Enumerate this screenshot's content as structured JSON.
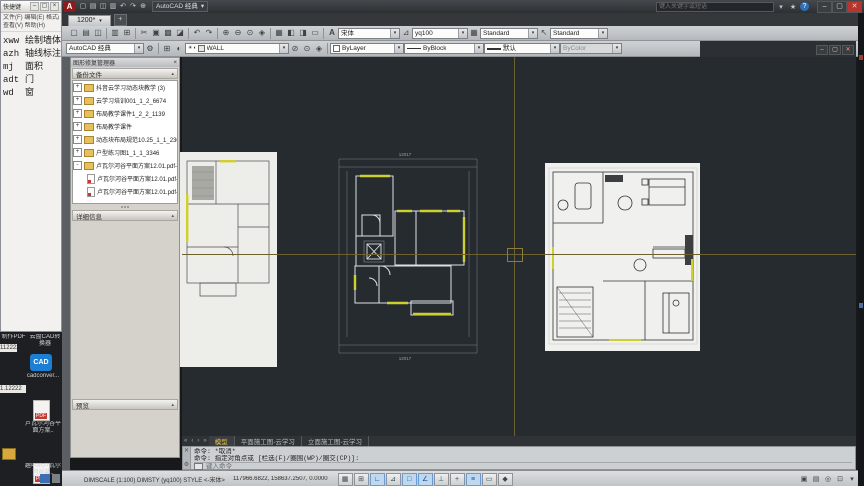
{
  "notepad": {
    "title": "快捷键",
    "menu1": "文件(F) 编辑(E) 格式(O)",
    "menu2": "查看(V) 帮助(H)",
    "entries": [
      {
        "k": "xww",
        "v": "绘制墙体"
      },
      {
        "k": "azh",
        "v": "轴线标注"
      },
      {
        "k": "mj",
        "v": "面积"
      },
      {
        "k": "adt",
        "v": "门"
      },
      {
        "k": "wd",
        "v": "窗"
      }
    ],
    "controls": {
      "min": "–",
      "max": "▢",
      "close": "×"
    }
  },
  "desktop": {
    "caption_left": "制作PDF",
    "caption_right": "云盘CAD转换器",
    "cad_icon_text": "CAD",
    "cad_label": "cadconver...",
    "chip1": "112222",
    "chip2": "1.12222",
    "pdf_badge": "PDF",
    "pdf1_label": "卢瓦尔河谷平面方案..",
    "pdf2_label": "趣叭叭卢瓦尔河谷装.."
  },
  "titlebar": {
    "logo": "A",
    "workspace": "AutoCAD 经典",
    "search_placeholder": "键入关键字或短语",
    "help": "?",
    "controls": {
      "min": "–",
      "max": "▢",
      "close": "✕"
    }
  },
  "filetabs": {
    "tab1": "1200*",
    "newtab": "+"
  },
  "toolbars": {
    "styles": {
      "text_style": "宋体",
      "dim_style": "yq100",
      "table_style": "Standard",
      "mleader_style": "Standard"
    },
    "workspace": "AutoCAD 经典",
    "layer": "WALL",
    "color": "ByLayer",
    "linetype": "ByBlock",
    "lineweight": "默认",
    "plotstyle": "ByColor"
  },
  "icons": {
    "qa": [
      "▢",
      "▤",
      "◫",
      "▥",
      "↶",
      "↷",
      "⊕",
      "▾"
    ],
    "std": [
      "▢",
      "▤",
      "◫",
      "▥",
      "⊞",
      "✂",
      "▣",
      "▩",
      "◪",
      "↶",
      "↷",
      "⊕",
      "⊖",
      "⊙",
      "◈",
      "▦",
      "◧",
      "◨",
      "▭",
      "⊿"
    ],
    "styles": [
      "A",
      "⊿",
      "▦",
      "↖"
    ],
    "ws_gear": "⚙",
    "layer_tools": [
      "☀",
      "◐",
      "▣",
      "⊞"
    ],
    "layer_combo": [
      "☀",
      "◐",
      "▪"
    ],
    "after_layer": [
      "⊘",
      "⊙",
      "◈"
    ],
    "tabnav": [
      "«",
      "‹",
      "›",
      "»"
    ],
    "cmd_close": "✕",
    "cmd_tool": "⚙",
    "doc_min": "–",
    "doc_max": "▢",
    "doc_close": "✕",
    "ic_star": "★",
    "ic_arrow": "▾",
    "toggles": [
      {
        "g": "▦"
      },
      {
        "g": "⊞"
      },
      {
        "g": "∟"
      },
      {
        "g": "⊿"
      },
      {
        "g": "□"
      },
      {
        "g": "∠"
      },
      {
        "g": "⊥"
      },
      {
        "g": "+"
      },
      {
        "g": "≡"
      },
      {
        "g": "▭"
      },
      {
        "g": "◆"
      }
    ],
    "status_right": [
      "▣",
      "▤",
      "◎",
      "⊡",
      "▾"
    ]
  },
  "palette": {
    "title": "图形修复管理器",
    "backup_header": "备份文件",
    "details_header": "详细信息",
    "preview_header": "预览",
    "caret": "▴",
    "tree": [
      {
        "exp": "+",
        "label": "抖音云学习动态块教学 (3)"
      },
      {
        "exp": "+",
        "label": "云学习培训001_1_2_6674"
      },
      {
        "exp": "+",
        "label": "布局教学课件1_2_2_1139"
      },
      {
        "exp": "+",
        "label": "布局教学课件"
      },
      {
        "exp": "+",
        "label": "动态块布局规范10.25_1_1_2305.dwg"
      },
      {
        "exp": "+",
        "label": "户型练习图1_1_1_3346"
      },
      {
        "exp": "-",
        "label": "卢瓦尔河谷平面方案12.01.pdf-2018-1"
      },
      {
        "exp": "",
        "label": "卢瓦尔河谷平面方案12.01.pdf-201"
      },
      {
        "exp": "",
        "label": "卢瓦尔河谷平面方案12.01.pdf-201"
      }
    ]
  },
  "drawing": {
    "dim_total_top": "12017",
    "dim_total_bottom": "12017"
  },
  "layout_tabs": {
    "model": "模型",
    "plan": "平面施工图-云学习",
    "elev": "立面施工图-云学习"
  },
  "command": {
    "line1": "命令: *取消*",
    "line2": "命令: 指定对角点或 [栏选(F)/圈围(WP)/圈交(CP)]:",
    "placeholder": "键入命令"
  },
  "statusbar": {
    "vars": "DIMSCALE (1:100) DIMSTY (yq100) STYLE <-宋体>",
    "coords": "117966.6822, 158637.2507, 0.0000"
  },
  "colors": {
    "accent_yellow": "#cfcf2e",
    "crosshair": "#6e6130",
    "close_red": "#b8342c"
  }
}
